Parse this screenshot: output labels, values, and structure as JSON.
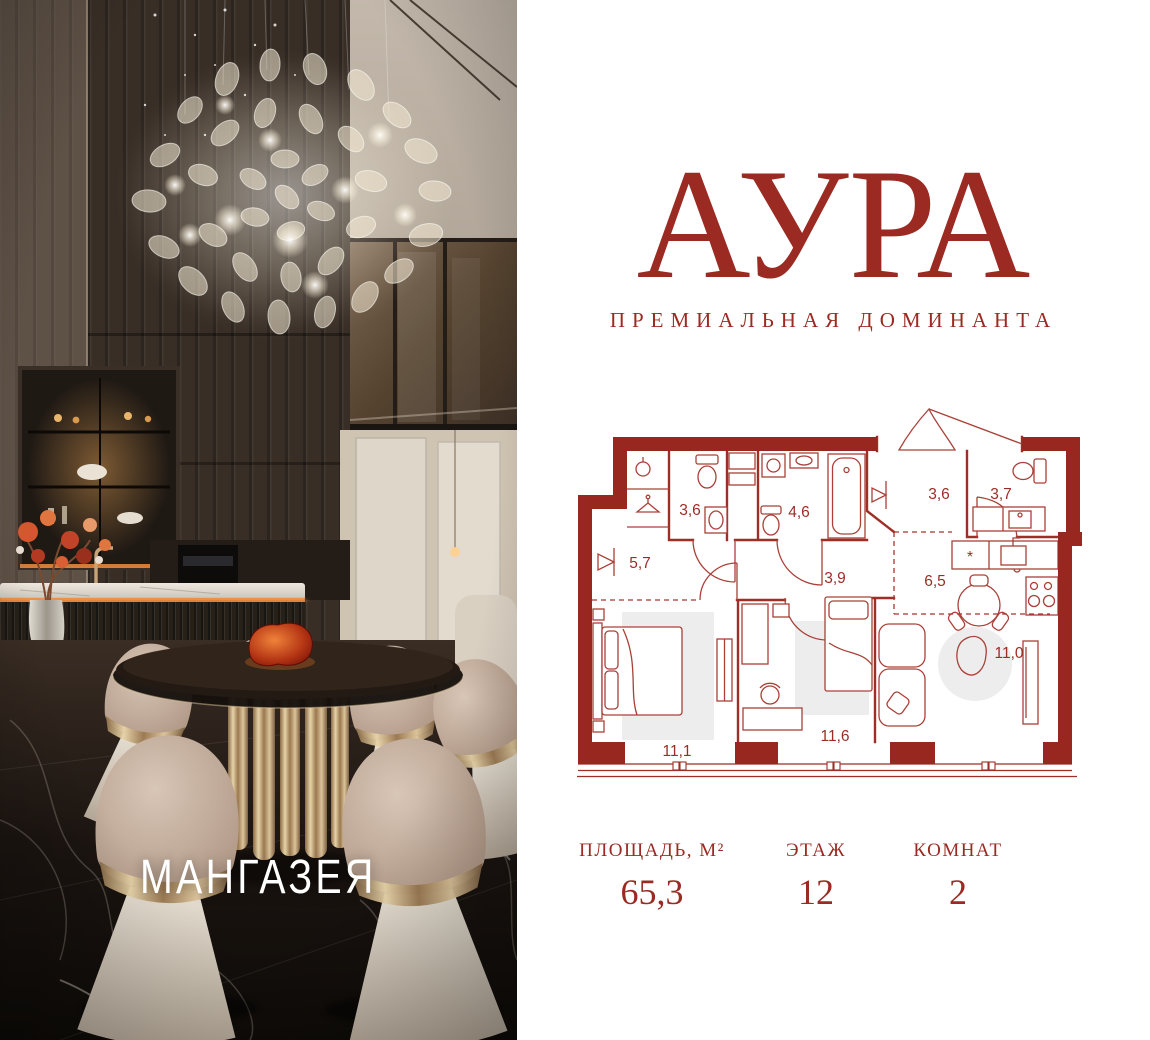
{
  "header": {
    "title": "АУРА",
    "tagline": "ПРЕМИАЛЬНАЯ ДОМИНАНТА"
  },
  "photo": {
    "overlay_brand": "МАНГАЗЕЯ"
  },
  "plan": {
    "fridge_symbol": "*",
    "rooms": [
      {
        "area": "3,6"
      },
      {
        "area": "4,6"
      },
      {
        "area": "3,6"
      },
      {
        "area": "3,7"
      },
      {
        "area": "5,7"
      },
      {
        "area": "3,9"
      },
      {
        "area": "6,5"
      },
      {
        "area": "11,0"
      },
      {
        "area": "11,1"
      },
      {
        "area": "11,6"
      }
    ]
  },
  "stats": {
    "items": [
      {
        "label": "ПЛОЩАДЬ, М²",
        "value": "65,3"
      },
      {
        "label": "ЭТАЖ",
        "value": "12"
      },
      {
        "label": "КОМНАТ",
        "value": "2"
      }
    ]
  },
  "colors": {
    "accent": "#9a2a22",
    "plan_wall": "#97271f",
    "plan_line": "#a5362d",
    "rug_gray": "#ededed",
    "photo_brand_text": "#ffffff",
    "background": "#ffffff"
  }
}
